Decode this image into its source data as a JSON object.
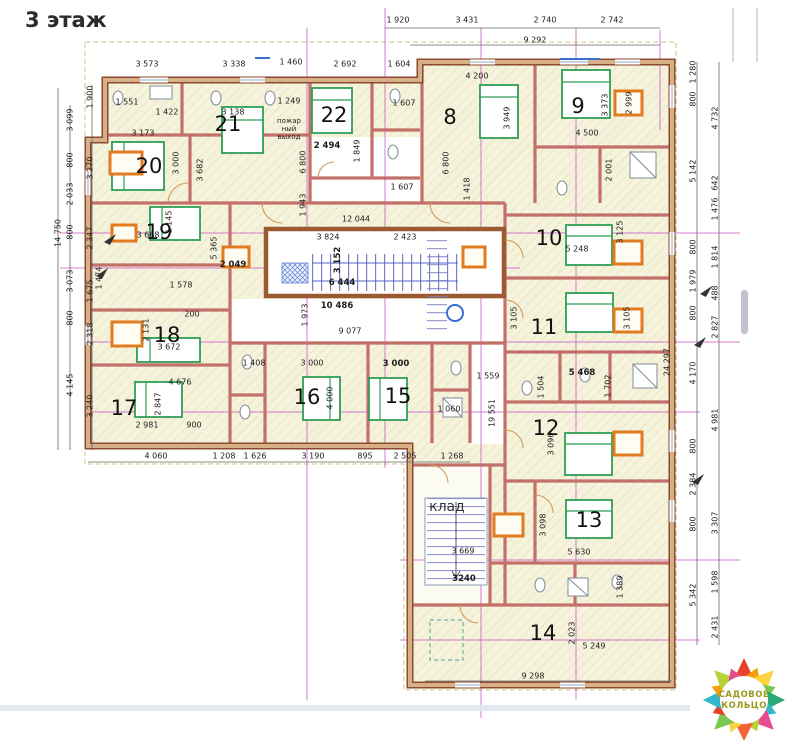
{
  "title": "3 этаж",
  "storage_label": "клад",
  "fire_exit": [
    "пожар",
    "ный",
    "выход"
  ],
  "logo": {
    "line1": "САДОВОЕ",
    "line2": "КОЛЬЦО"
  },
  "colors": {
    "wall-dark": "#8a4b2f",
    "wall-light": "#d8b088",
    "partition": "#c4706a",
    "bed": "#2f9e55",
    "orange": "#e07b1f",
    "grid": "#c750c7",
    "stair": "#7d7fc4",
    "logo-text": "#99991f"
  },
  "room_numbers": [
    {
      "n": "8",
      "x": 450,
      "y": 117
    },
    {
      "n": "9",
      "x": 578,
      "y": 106
    },
    {
      "n": "10",
      "x": 549,
      "y": 238
    },
    {
      "n": "11",
      "x": 544,
      "y": 327
    },
    {
      "n": "12",
      "x": 546,
      "y": 428
    },
    {
      "n": "13",
      "x": 589,
      "y": 520
    },
    {
      "n": "14",
      "x": 543,
      "y": 633
    },
    {
      "n": "15",
      "x": 398,
      "y": 396
    },
    {
      "n": "16",
      "x": 307,
      "y": 397
    },
    {
      "n": "17",
      "x": 124,
      "y": 408
    },
    {
      "n": "18",
      "x": 167,
      "y": 335
    },
    {
      "n": "19",
      "x": 159,
      "y": 232
    },
    {
      "n": "20",
      "x": 149,
      "y": 166
    },
    {
      "n": "21",
      "x": 228,
      "y": 124
    },
    {
      "n": "22",
      "x": 334,
      "y": 115
    }
  ],
  "dim_labels": [
    {
      "t": "1 920",
      "x": 398,
      "y": 20
    },
    {
      "t": "3 431",
      "x": 467,
      "y": 20
    },
    {
      "t": "2 740",
      "x": 545,
      "y": 20
    },
    {
      "t": "2 742",
      "x": 612,
      "y": 20
    },
    {
      "t": "9 292",
      "x": 535,
      "y": 40
    },
    {
      "t": "3 573",
      "x": 147,
      "y": 64
    },
    {
      "t": "3 338",
      "x": 234,
      "y": 64
    },
    {
      "t": "1 460",
      "x": 291,
      "y": 62
    },
    {
      "t": "2 692",
      "x": 345,
      "y": 64
    },
    {
      "t": "1 604",
      "x": 399,
      "y": 64
    },
    {
      "t": "4 200",
      "x": 477,
      "y": 76
    },
    {
      "t": "14 750",
      "x": 58,
      "y": 233,
      "r": 1
    },
    {
      "t": "3 099",
      "x": 70,
      "y": 120,
      "r": 1
    },
    {
      "t": "800",
      "x": 70,
      "y": 160,
      "r": 1
    },
    {
      "t": "2 033",
      "x": 70,
      "y": 194,
      "r": 1
    },
    {
      "t": "800",
      "x": 70,
      "y": 232,
      "r": 1
    },
    {
      "t": "3 073",
      "x": 70,
      "y": 281,
      "r": 1
    },
    {
      "t": "800",
      "x": 70,
      "y": 318,
      "r": 1
    },
    {
      "t": "4 145",
      "x": 70,
      "y": 385,
      "r": 1
    },
    {
      "t": "1 900",
      "x": 90,
      "y": 97,
      "r": 1
    },
    {
      "t": "3 270",
      "x": 90,
      "y": 168,
      "r": 1
    },
    {
      "t": "2 347",
      "x": 90,
      "y": 238,
      "r": 1
    },
    {
      "t": "1 675",
      "x": 90,
      "y": 291,
      "r": 1
    },
    {
      "t": "2 318",
      "x": 90,
      "y": 334,
      "r": 1
    },
    {
      "t": "3 240",
      "x": 90,
      "y": 406,
      "r": 1
    },
    {
      "t": "1 280",
      "x": 693,
      "y": 72,
      "r": 1
    },
    {
      "t": "800",
      "x": 693,
      "y": 99,
      "r": 1
    },
    {
      "t": "5 142",
      "x": 693,
      "y": 171,
      "r": 1
    },
    {
      "t": "800",
      "x": 693,
      "y": 247,
      "r": 1
    },
    {
      "t": "1 979",
      "x": 693,
      "y": 281,
      "r": 1
    },
    {
      "t": "800",
      "x": 693,
      "y": 313,
      "r": 1
    },
    {
      "t": "4 170",
      "x": 693,
      "y": 373,
      "r": 1
    },
    {
      "t": "800",
      "x": 693,
      "y": 446,
      "r": 1
    },
    {
      "t": "2 384",
      "x": 693,
      "y": 484,
      "r": 1
    },
    {
      "t": "800",
      "x": 693,
      "y": 524,
      "r": 1
    },
    {
      "t": "5 342",
      "x": 693,
      "y": 595,
      "r": 1
    },
    {
      "t": "4 732",
      "x": 715,
      "y": 118,
      "r": 1
    },
    {
      "t": "642",
      "x": 715,
      "y": 183,
      "r": 1
    },
    {
      "t": "1 476",
      "x": 715,
      "y": 209,
      "r": 1
    },
    {
      "t": "1 814",
      "x": 715,
      "y": 257,
      "r": 1
    },
    {
      "t": "488",
      "x": 715,
      "y": 293,
      "r": 1
    },
    {
      "t": "2 827",
      "x": 715,
      "y": 327,
      "r": 1
    },
    {
      "t": "4 981",
      "x": 715,
      "y": 420,
      "r": 1
    },
    {
      "t": "3 307",
      "x": 715,
      "y": 523,
      "r": 1
    },
    {
      "t": "1 598",
      "x": 715,
      "y": 582,
      "r": 1
    },
    {
      "t": "2 431",
      "x": 715,
      "y": 627,
      "r": 1
    },
    {
      "t": "1 551",
      "x": 127,
      "y": 102
    },
    {
      "t": "1 422",
      "x": 167,
      "y": 112
    },
    {
      "t": "3 173",
      "x": 143,
      "y": 133
    },
    {
      "t": "3 138",
      "x": 233,
      "y": 112
    },
    {
      "t": "3 682",
      "x": 200,
      "y": 170,
      "r": 1
    },
    {
      "t": "3 000",
      "x": 176,
      "y": 163,
      "r": 1
    },
    {
      "t": "1 249",
      "x": 289,
      "y": 101
    },
    {
      "t": "6 800",
      "x": 303,
      "y": 162,
      "r": 1
    },
    {
      "t": "1 943",
      "x": 303,
      "y": 205,
      "r": 1
    },
    {
      "t": "2 494",
      "x": 327,
      "y": 146,
      "b": 1
    },
    {
      "t": "1 849",
      "x": 357,
      "y": 151,
      "r": 1
    },
    {
      "t": "1 607",
      "x": 404,
      "y": 103
    },
    {
      "t": "1 607",
      "x": 402,
      "y": 187
    },
    {
      "t": "6 800",
      "x": 446,
      "y": 163,
      "r": 1
    },
    {
      "t": "3 949",
      "x": 507,
      "y": 118,
      "r": 1
    },
    {
      "t": "1 418",
      "x": 467,
      "y": 189,
      "r": 1
    },
    {
      "t": "4 500",
      "x": 587,
      "y": 133
    },
    {
      "t": "2 001",
      "x": 609,
      "y": 170,
      "r": 1
    },
    {
      "t": "3 373",
      "x": 605,
      "y": 105,
      "r": 1
    },
    {
      "t": "2 999",
      "x": 629,
      "y": 103,
      "r": 1
    },
    {
      "t": "5 248",
      "x": 577,
      "y": 249
    },
    {
      "t": "3 125",
      "x": 620,
      "y": 232,
      "r": 1
    },
    {
      "t": "3 105",
      "x": 514,
      "y": 318,
      "r": 1
    },
    {
      "t": "3 105",
      "x": 627,
      "y": 318,
      "r": 1
    },
    {
      "t": "12 044",
      "x": 356,
      "y": 219
    },
    {
      "t": "3 824",
      "x": 328,
      "y": 237
    },
    {
      "t": "2 423",
      "x": 405,
      "y": 237
    },
    {
      "t": "3 152",
      "x": 338,
      "y": 260,
      "r": 1,
      "b": 1
    },
    {
      "t": "6 444",
      "x": 342,
      "y": 283,
      "b": 1
    },
    {
      "t": "10 486",
      "x": 337,
      "y": 306,
      "b": 1
    },
    {
      "t": "1 973",
      "x": 305,
      "y": 315,
      "r": 1
    },
    {
      "t": "9 077",
      "x": 350,
      "y": 331
    },
    {
      "t": "3 668",
      "x": 148,
      "y": 235
    },
    {
      "t": "1 145",
      "x": 169,
      "y": 222,
      "r": 1
    },
    {
      "t": "5 365",
      "x": 214,
      "y": 248,
      "r": 1
    },
    {
      "t": "2 049",
      "x": 233,
      "y": 265,
      "b": 1
    },
    {
      "t": "1 474",
      "x": 99,
      "y": 278,
      "r": 1
    },
    {
      "t": "1 578",
      "x": 181,
      "y": 285
    },
    {
      "t": "200",
      "x": 192,
      "y": 314
    },
    {
      "t": "2 131",
      "x": 146,
      "y": 330,
      "r": 1
    },
    {
      "t": "3 672",
      "x": 169,
      "y": 347
    },
    {
      "t": "4 676",
      "x": 180,
      "y": 382
    },
    {
      "t": "2 847",
      "x": 158,
      "y": 404,
      "r": 1
    },
    {
      "t": "2 981",
      "x": 147,
      "y": 425
    },
    {
      "t": "900",
      "x": 194,
      "y": 425
    },
    {
      "t": "1 408",
      "x": 254,
      "y": 363
    },
    {
      "t": "3 000",
      "x": 312,
      "y": 363
    },
    {
      "t": "3 000",
      "x": 396,
      "y": 364,
      "b": 1
    },
    {
      "t": "4 000",
      "x": 330,
      "y": 398,
      "r": 1
    },
    {
      "t": "1 060",
      "x": 449,
      "y": 409
    },
    {
      "t": "1 559",
      "x": 488,
      "y": 376
    },
    {
      "t": "19 551",
      "x": 492,
      "y": 413,
      "r": 1
    },
    {
      "t": "24 297",
      "x": 667,
      "y": 362,
      "r": 1
    },
    {
      "t": "4 060",
      "x": 156,
      "y": 456
    },
    {
      "t": "1 208",
      "x": 224,
      "y": 456
    },
    {
      "t": "1 626",
      "x": 255,
      "y": 456
    },
    {
      "t": "3 190",
      "x": 313,
      "y": 456
    },
    {
      "t": "895",
      "x": 365,
      "y": 456
    },
    {
      "t": "2 505",
      "x": 405,
      "y": 456
    },
    {
      "t": "1 268",
      "x": 452,
      "y": 456
    },
    {
      "t": "5 468",
      "x": 582,
      "y": 373,
      "b": 1
    },
    {
      "t": "1 504",
      "x": 541,
      "y": 387,
      "r": 1
    },
    {
      "t": "1 702",
      "x": 608,
      "y": 386,
      "r": 1
    },
    {
      "t": "3 096",
      "x": 551,
      "y": 444,
      "r": 1
    },
    {
      "t": "3 098",
      "x": 543,
      "y": 525,
      "r": 1
    },
    {
      "t": "5 630",
      "x": 579,
      "y": 552
    },
    {
      "t": "1 389",
      "x": 620,
      "y": 587,
      "r": 1
    },
    {
      "t": "3 669",
      "x": 463,
      "y": 551
    },
    {
      "t": "3240",
      "x": 464,
      "y": 579,
      "b": 1
    },
    {
      "t": "2 023",
      "x": 572,
      "y": 633,
      "r": 1
    },
    {
      "t": "5 249",
      "x": 594,
      "y": 646
    },
    {
      "t": "9 298",
      "x": 533,
      "y": 676
    }
  ]
}
